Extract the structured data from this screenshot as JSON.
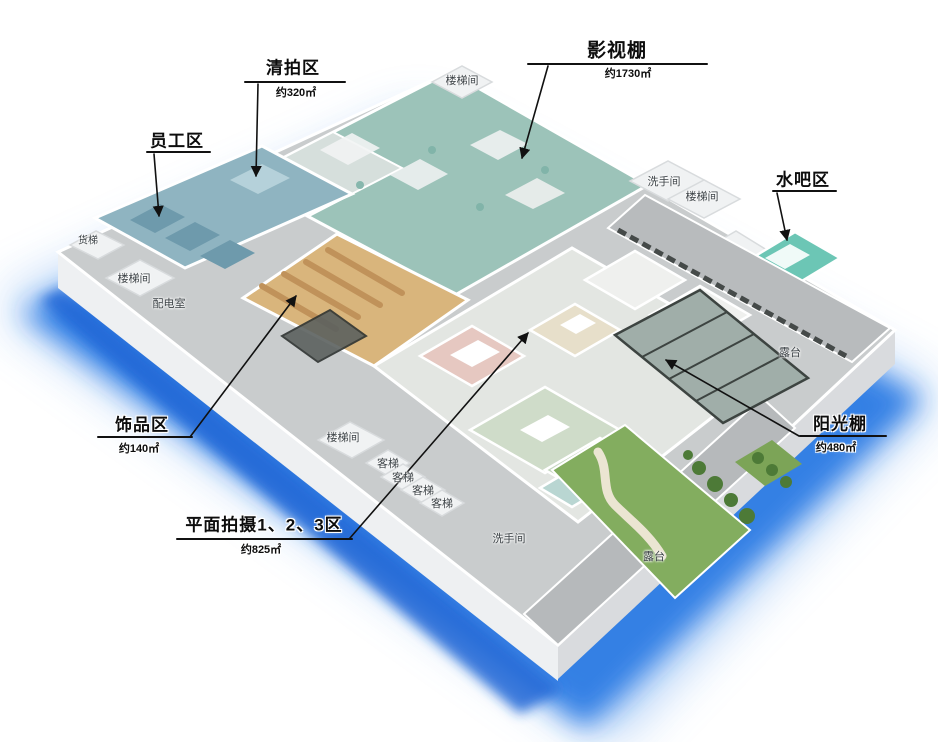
{
  "colors": {
    "glow_strong": "#2f7de4",
    "glow_soft": "#5c9bee",
    "glow_deep": "#2467d6",
    "slab_top": "#c9cccd",
    "slab_front": "#eef0f2",
    "slab_side": "#d9dbde",
    "studio": "#9cc3b9",
    "clear_shoot": "#d6dfdc",
    "office": "#8fb4c1",
    "accessories": "#d9b57c",
    "room_pink": "#e6c8c1",
    "room_beige": "#e7dfca",
    "room_green": "#cfdcc9",
    "room_white": "#eff0ee",
    "water_bar": "#6cc6b5",
    "sunroom": "#a0aea9",
    "lawn": "#83ad5f",
    "terrace": "#b8bbbd",
    "white_block": "#f0f2f3",
    "leader": "#111111",
    "wall": "#ffffff"
  },
  "callouts": [
    {
      "label": "影视棚",
      "area": "约1730㎡"
    },
    {
      "label": "清拍区",
      "area": "约320㎡"
    },
    {
      "label": "员工区",
      "area": ""
    },
    {
      "label": "水吧区",
      "area": ""
    },
    {
      "label": "饰品区",
      "area": "约140㎡"
    },
    {
      "label": "平面拍摄1、2、3区",
      "area": "约825㎡"
    },
    {
      "label": "阳光棚",
      "area": "约480㎡"
    }
  ],
  "room_labels": [
    {
      "text": "货梯"
    },
    {
      "text": "楼梯间"
    },
    {
      "text": "配电室"
    },
    {
      "text": "楼梯间"
    },
    {
      "text": "洗手间"
    },
    {
      "text": "楼梯间"
    },
    {
      "text": "露台"
    },
    {
      "text": "楼梯间"
    },
    {
      "text": "客梯"
    },
    {
      "text": "客梯"
    },
    {
      "text": "客梯"
    },
    {
      "text": "客梯"
    },
    {
      "text": "洗手间"
    },
    {
      "text": "露台"
    }
  ]
}
